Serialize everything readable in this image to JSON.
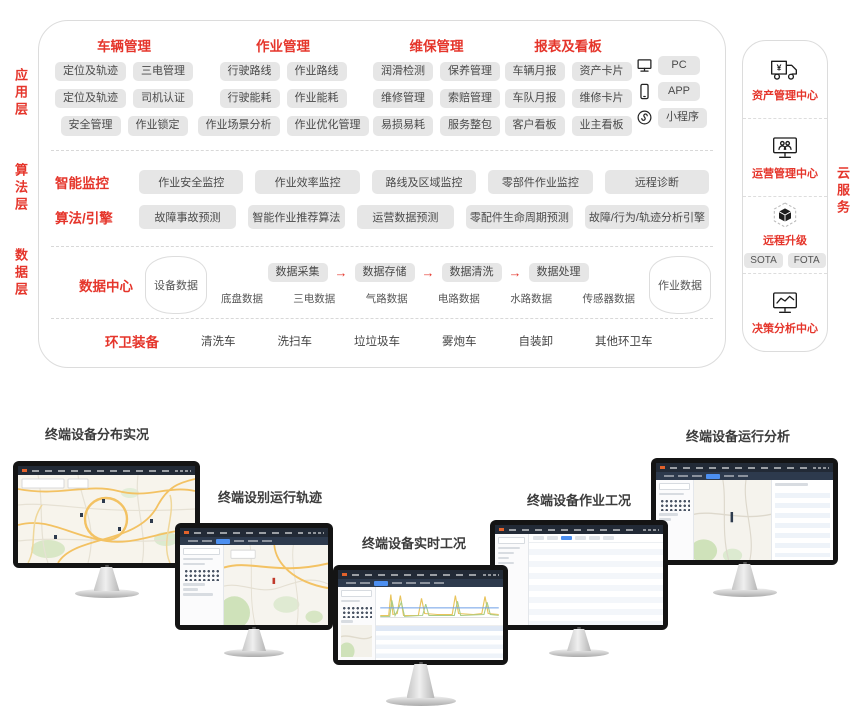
{
  "colors": {
    "accent_red": "#e5352b",
    "chip_bg": "#e6e6e6",
    "chip_text": "#4a4a4a",
    "navbar_dark": "#222a36",
    "active_blue": "#4c8ff0"
  },
  "layer_labels": [
    "应用层",
    "算法层",
    "数据层"
  ],
  "app": {
    "groups": [
      {
        "title": "车辆管理",
        "rows": [
          [
            "定位及轨迹",
            "三电管理"
          ],
          [
            "定位及轨迹",
            "司机认证"
          ],
          [
            "安全管理",
            "作业锁定"
          ]
        ]
      },
      {
        "title": "作业管理",
        "rows": [
          [
            "行驶路线",
            "作业路线"
          ],
          [
            "行驶能耗",
            "作业能耗"
          ],
          [
            "作业场景分析",
            "作业优化管理"
          ]
        ]
      },
      {
        "title": "维保管理",
        "rows": [
          [
            "润滑检测",
            "保养管理"
          ],
          [
            "维修管理",
            "索赔管理"
          ],
          [
            "易损易耗",
            "服务整包"
          ]
        ]
      },
      {
        "title": "报表及看板",
        "rows": [
          [
            "车辆月报",
            "资产卡片"
          ],
          [
            "车队月报",
            "维修卡片"
          ],
          [
            "客户看板",
            "业主看板"
          ]
        ]
      }
    ],
    "access": [
      {
        "icon": "pc-icon",
        "label": "PC"
      },
      {
        "icon": "app-icon",
        "label": "APP"
      },
      {
        "icon": "miniprogram-icon",
        "label": "小程序"
      }
    ]
  },
  "algo": {
    "rows": [
      {
        "title": "智能监控",
        "chips": [
          "作业安全监控",
          "作业效率监控",
          "路线及区域监控",
          "零部件作业监控",
          "远程诊断"
        ]
      },
      {
        "title": "算法/引擎",
        "chips": [
          "故障事故预测",
          "智能作业推荐算法",
          "运营数据预测",
          "零配件生命周期预测",
          "故障/行为/轨迹分析引擎"
        ]
      }
    ]
  },
  "data_center": {
    "title": "数据中心",
    "left_store": "设备数据",
    "right_store": "作业数据",
    "arrow": "→",
    "flow": [
      "数据采集",
      "数据存储",
      "数据清洗",
      "数据处理"
    ],
    "sources": [
      "底盘数据",
      "三电数据",
      "气路数据",
      "电路数据",
      "水路数据",
      "传感器数据"
    ]
  },
  "equipment": {
    "title": "环卫装备",
    "items": [
      "清洗车",
      "洗扫车",
      "垃垃圾车",
      "雾炮车",
      "自装卸",
      "其他环卫车"
    ]
  },
  "cloud": {
    "side_label": "云服务",
    "sections": [
      {
        "icon": "truck-yen-icon",
        "label": "资产管理中心"
      },
      {
        "icon": "monitor-users-icon",
        "label": "运营管理中心"
      },
      {
        "icon": "ota-cube-icon",
        "label": "远程升级",
        "chips": [
          "SOTA",
          "FOTA"
        ]
      },
      {
        "icon": "monitor-chart-icon",
        "label": "决策分析中心"
      }
    ]
  },
  "monitors": [
    {
      "label": "终端设备分布实况",
      "screen": "map"
    },
    {
      "label": "终端设别运行轨迹",
      "screen": "map-panel"
    },
    {
      "label": "终端设备实时工况",
      "screen": "chart"
    },
    {
      "label": "终端设备作业工况",
      "screen": "table"
    },
    {
      "label": "终端设备运行分析",
      "screen": "map-table"
    }
  ]
}
